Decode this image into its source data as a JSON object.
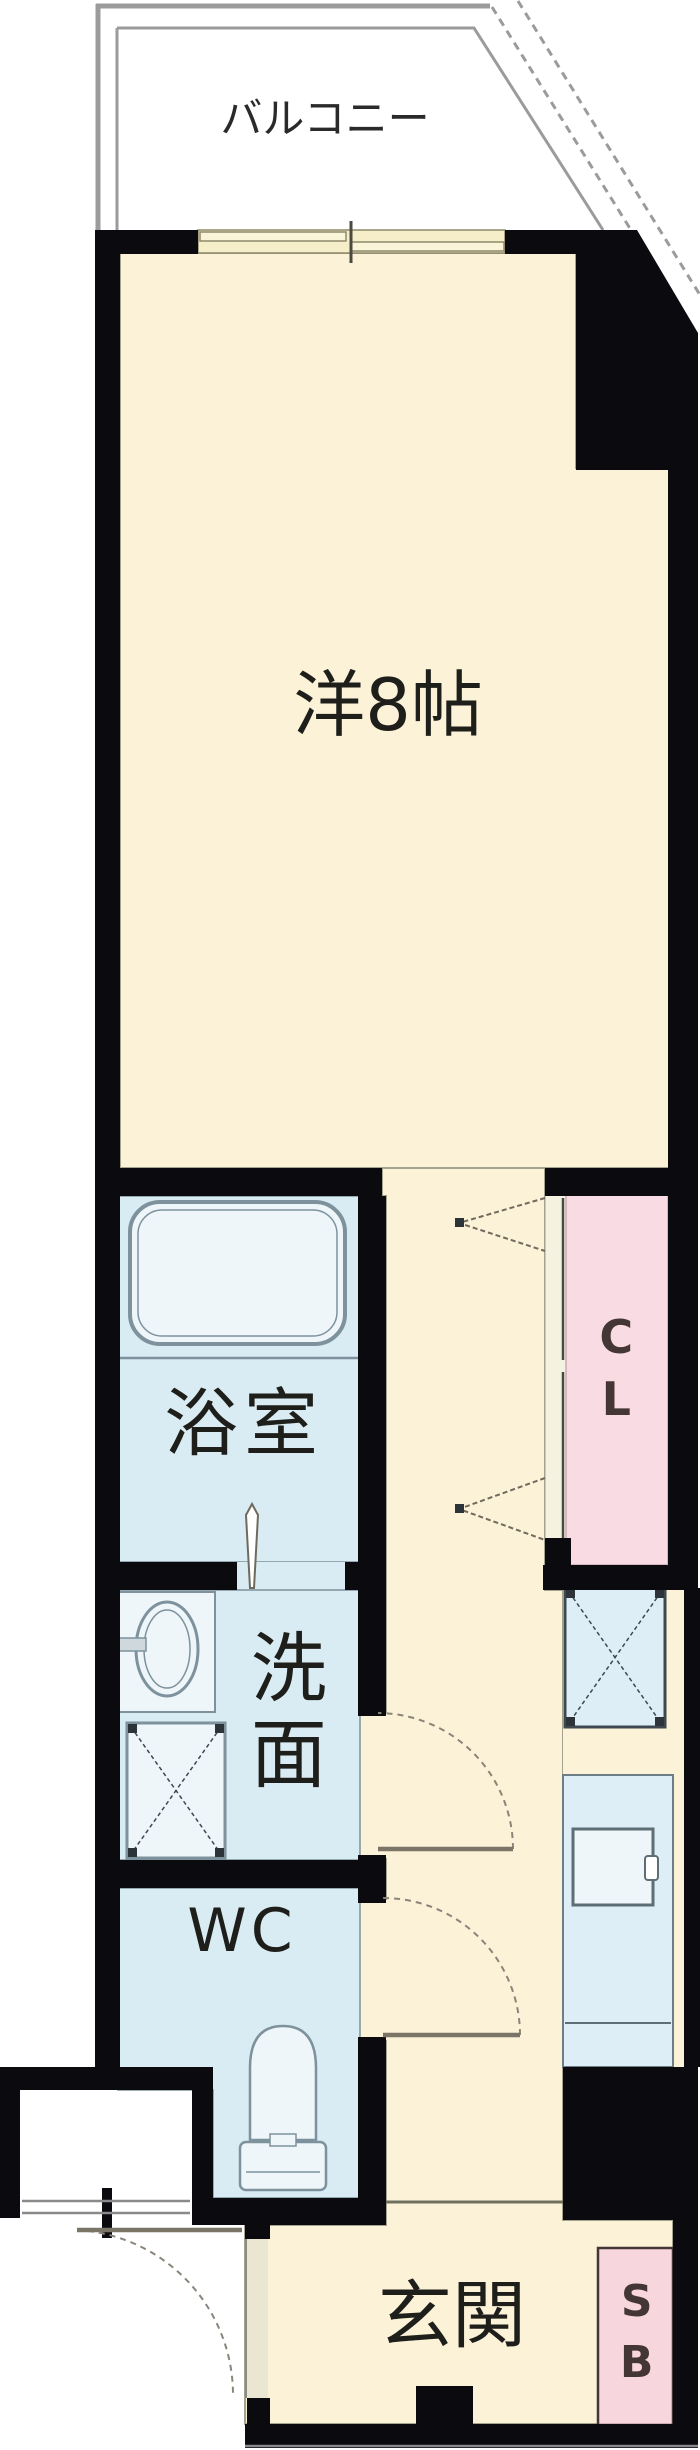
{
  "floor_plan": {
    "kind": "japanese-apartment-floor-plan",
    "labels": {
      "balcony": "バルコニー",
      "main_room": "洋8帖",
      "bathroom": "浴室",
      "washroom": "洗面",
      "toilet": "WC",
      "closet": "CL",
      "entrance": "玄関",
      "shoe_box": "SB"
    },
    "colors": {
      "wall": "#0b0b0f",
      "room_cream": "#fcf2d8",
      "window_cream": "#f5eec9",
      "water_blue": "#d9ebf3",
      "fixture_blue": "#eef6fa",
      "panel_blue": "#ddeef6",
      "closet_pink": "#f9dce3",
      "shoebox_pink": "#f7d6dd",
      "balcony_gray": "#9b9b9b",
      "fixture_stroke": "#7d929c",
      "door_line": "#7b7568",
      "label_dark": "#1e1e1a",
      "label_brown": "#453636",
      "hairline": "#a5a28e",
      "frame_olive": "#8f8a6b"
    }
  }
}
